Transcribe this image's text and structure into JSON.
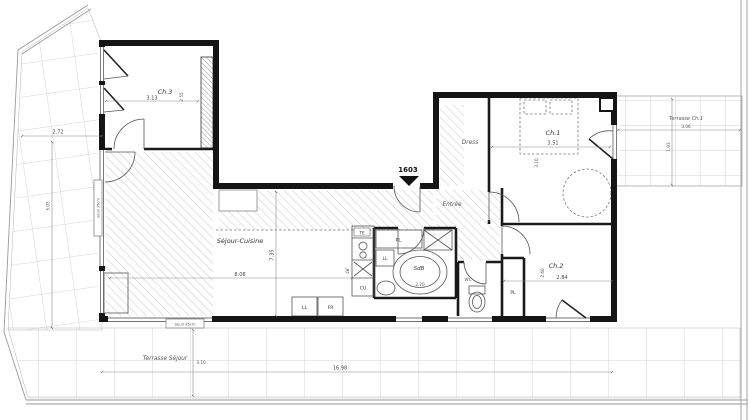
{
  "floorplan": {
    "lot_number": "1603",
    "colors": {
      "walls": "#151515",
      "hatch": "#adadad",
      "tile_grid": "#c9c9c9",
      "background": "#ffffff"
    },
    "rooms": {
      "ch3": {
        "label": "Ch.3",
        "width": "3.13",
        "depth": "2.55"
      },
      "sejour": {
        "label": "Séjour-Cuisine",
        "width": "8.08",
        "depth": "7.35"
      },
      "entree": {
        "label": "Entrée"
      },
      "dress": {
        "label": "Dress"
      },
      "ch1": {
        "label": "Ch.1",
        "width": "3.51",
        "depth": "3.10"
      },
      "ch2": {
        "label": "Ch.2",
        "width": "2.84",
        "depth": "2.60"
      },
      "sdb": {
        "label": "SdB",
        "width": "2.20"
      },
      "wc": {
        "label": "WC"
      }
    },
    "closets": {
      "kitchen": "PL.",
      "ch2": "PL"
    },
    "fixtures": {
      "te": "TE",
      "lv": "LV",
      "cu": "CU",
      "ll_bath": "LL",
      "ll": "LL",
      "fr": "FR"
    },
    "terraces": {
      "sejour": {
        "label": "Terrasse Séjour",
        "depth": "3.10"
      },
      "ch1": {
        "label": "Terrasse Ch.1",
        "width": "3.06",
        "depth": "1.93"
      },
      "left": {
        "width": "2.72",
        "depth": "5.05"
      }
    },
    "dimensions": {
      "total_width": "16.98"
    },
    "thresholds": {
      "bottom": "Seuil 35cm",
      "left": "Seuil 35cm"
    }
  }
}
